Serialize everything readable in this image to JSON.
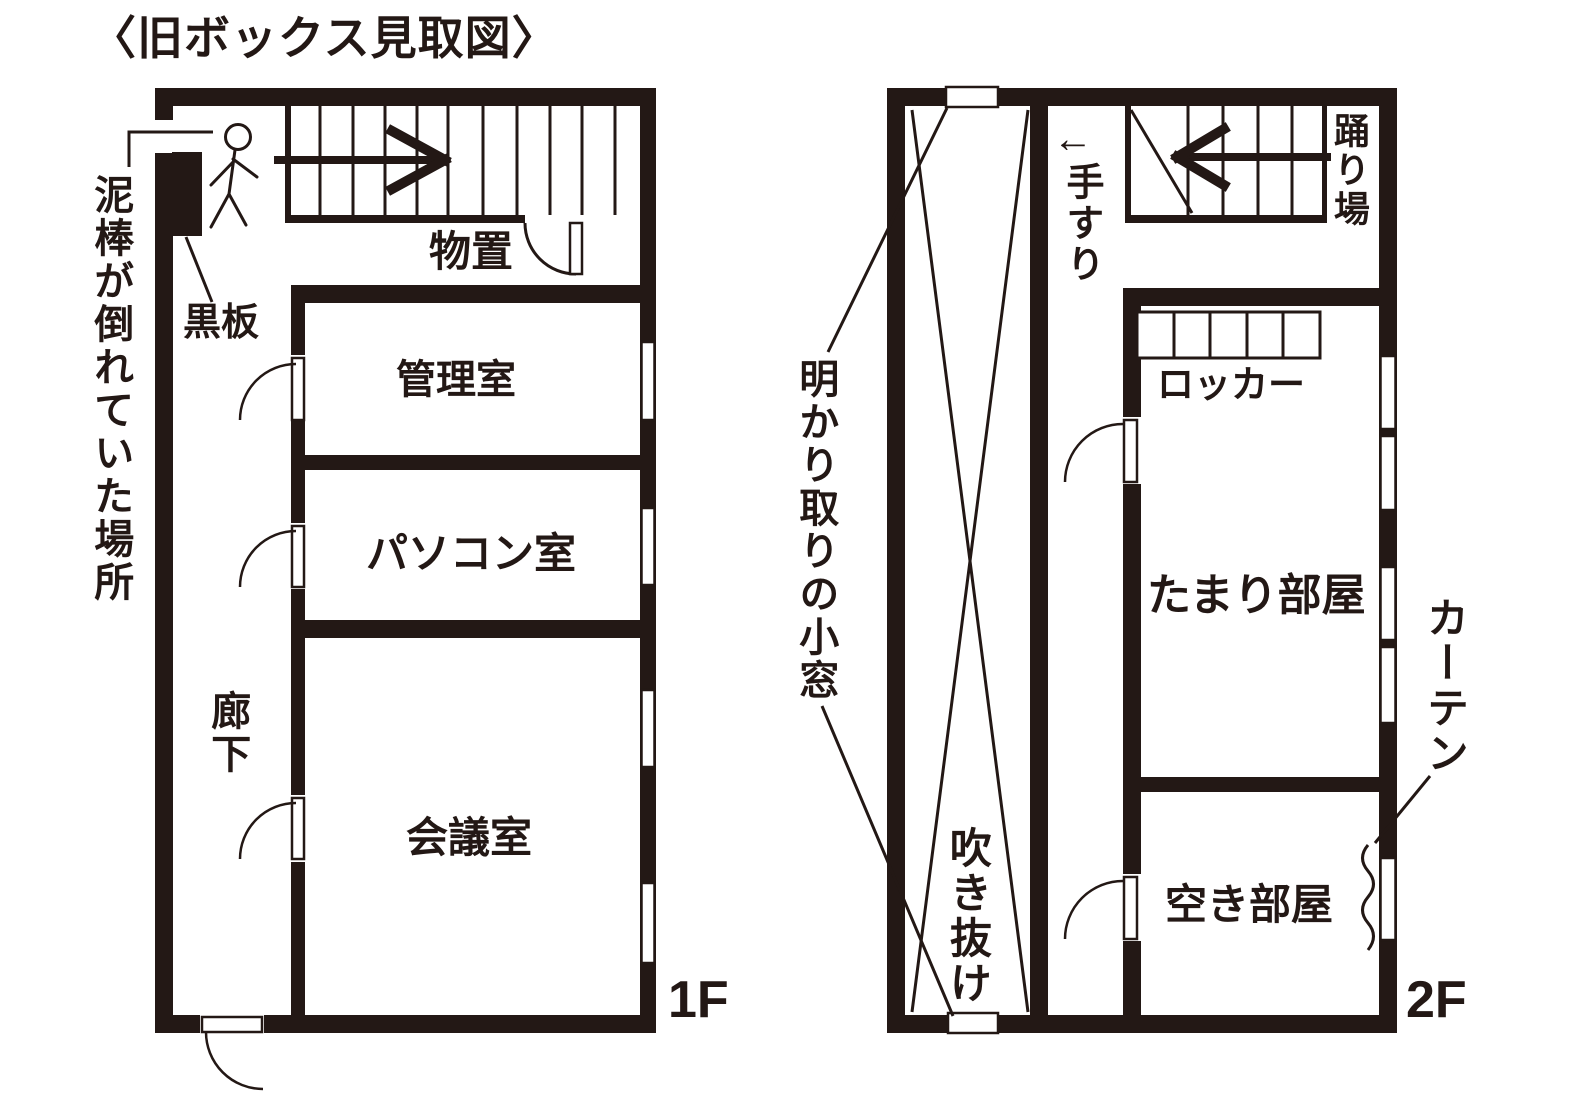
{
  "title": "〈旧ボックス見取図〉",
  "ink_color": "#231815",
  "floor1": {
    "floor_label": "1F",
    "rooms": {
      "storage": "物置",
      "admin_room": "管理室",
      "pc_room": "パソコン室",
      "meeting_room": "会議室",
      "corridor": "廊下"
    },
    "annotations": {
      "thief_spot": "泥棒が倒れていた場所",
      "blackboard": "黒板"
    }
  },
  "floor2": {
    "floor_label": "2F",
    "rooms": {
      "tamari_room": "たまり部屋",
      "empty_room": "空き部屋",
      "atrium": "吹き抜け",
      "landing": "踊り場"
    },
    "annotations": {
      "handrail_arrow": "←",
      "handrail": "手すり",
      "locker": "ロッカー",
      "skylight_window": "明かり取りの小窓",
      "curtain": "カーテン"
    }
  }
}
